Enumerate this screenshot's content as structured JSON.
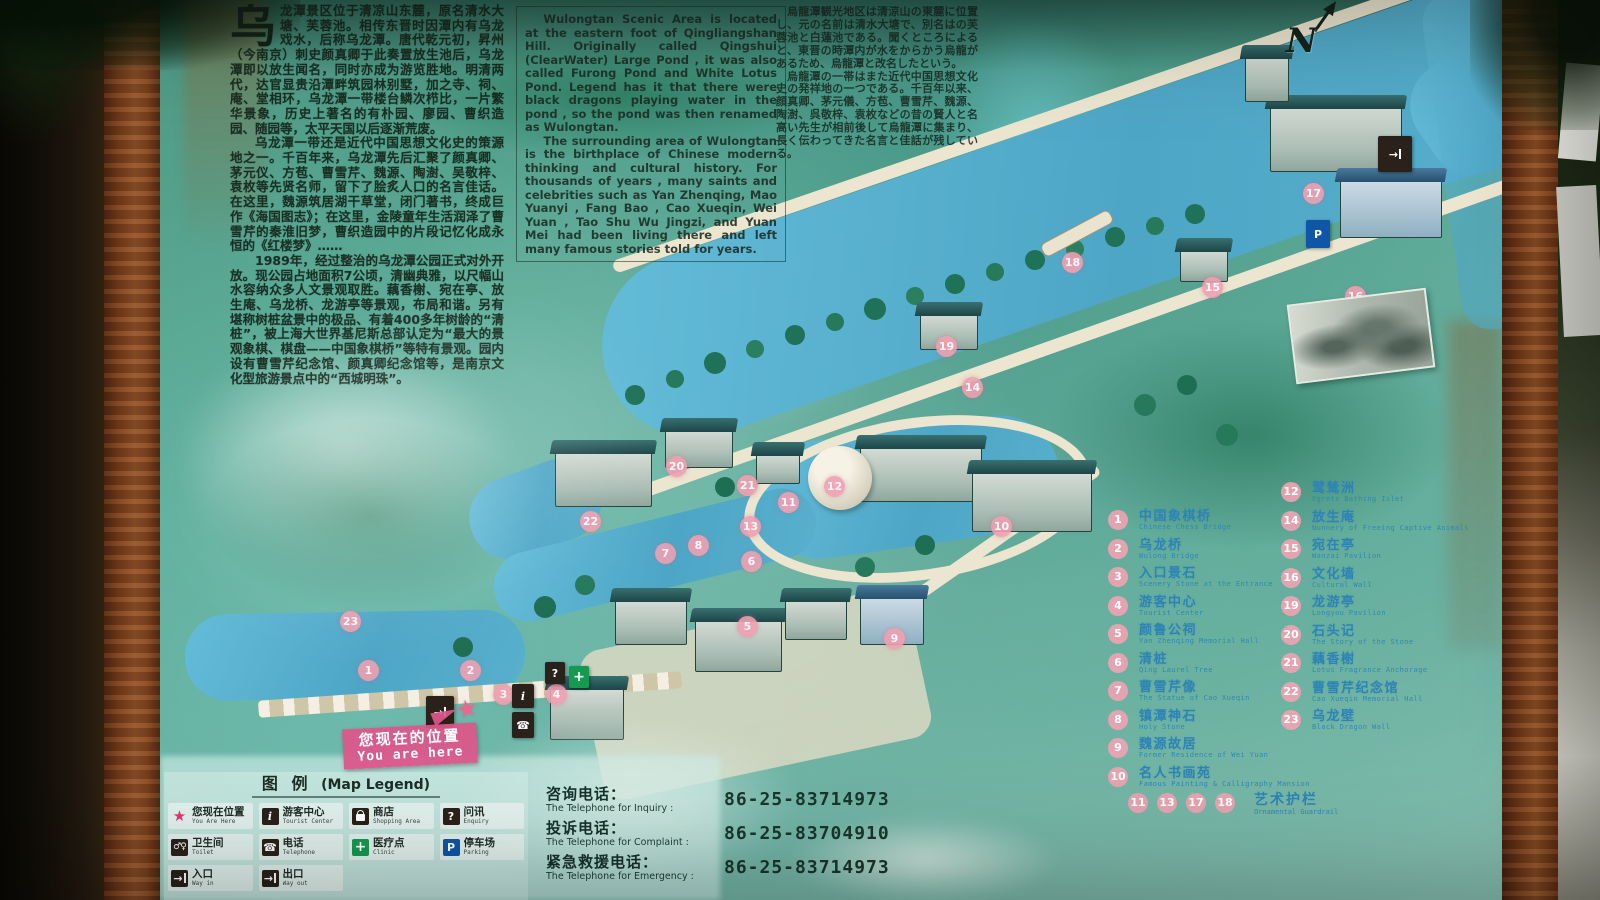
{
  "board": {
    "intro_zh": {
      "drop_cap": "乌",
      "p1": "龙潭景区位于清凉山东麓，原名清水大塘、芙蓉池。相传东晋时因潭内有乌龙戏水，后称乌龙潭。唐代乾元初，昇州（今南京）刺史颜真卿于此奏置放生池后，乌龙潭即以放生闻名，同时亦成为游览胜地。明清两代，达官显贵沿潭畔筑园林别墅，加之寺、祠、庵、堂相环，乌龙潭一带楼台鳞次栉比，一片繁华景象，历史上著名的有朴园、廖园、曹织造园、随园等，太平天国以后逐渐荒废。",
      "p2": "乌龙潭一带还是近代中国思想文化史的策源地之一。千百年来，乌龙潭先后汇聚了颜真卿、茅元仪、方苞、曹雪芹、魏源、陶澍、吴敬梓、袁枚等先贤名师，留下了脍炙人口的名言佳话。在这里，魏源筑居湖干草堂，闭门著书，终成巨作《海国图志》；在这里，金陵童年生活润泽了曹雪芹的秦淮旧梦，曹织造园中的片段记忆化成永恒的《红楼梦》……",
      "p3": "1989年，经过整治的乌龙潭公园正式对外开放。现公园占地面积7公顷，清幽典雅，以尺幅山水容纳众多人文景观取胜。藕香榭、宛在亭、放生庵、乌龙桥、龙游亭等景观，布局和谐。另有堪称树桩盆景中的极品、有着400多年树龄的“清桩”，被上海大世界基尼斯总部认定为“最大的景观象棋、棋盘——中国象棋桥”等特有景观。园内设有曹雪芹纪念馆、颜真卿纪念馆等，是南京文化型旅游景点中的“西城明珠”。"
    },
    "intro_en": {
      "p1": "Wulongtan Scenic Area is located at the eastern foot of Qingliangshan Hill. Originally called Qingshui (ClearWater) Large Pond , it was also called Furong Pond and White Lotus Pond. Legend has it that there were black dragons playing water in the pond , so the pond was then renamed as Wulongtan.",
      "p2": "The surrounding area of Wulongtan is the birthplace of Chinese modern thinking and cultural history. For thousands of years , many saints and celebrities such as Yan Zhenqing, Mao Yuanyi , Fang Bao , Cao Xueqin, Wei Yuan , Tao Shu Wu Jingzi, and Yuan Mei had been living there and left many famous stories told for years."
    },
    "intro_ja": {
      "p1": "烏龍潭観光地区は清涼山の東麓に位置し、元の名前は清水大塘で、別名はの芙蓉池と白蓮池である。聞くところによると、東晋の時潭内が水をからかう烏龍があるため、烏龍潭と改名したという。",
      "p2": "烏龍潭の一帯はまた近代中国思想文化史の発祥地の一つである。千百年以来、顔真卿、茅元儀、方苞、曹雪芹、魏源、陶澍、呉敬梓、袁枚などの昔の賢人と名高い先生が相前後して烏龍潭に集まり、長く伝わってきた名言と佳話が残している。"
    },
    "compass": {
      "label": "N"
    },
    "you_are_here": {
      "zh": "您现在的位置",
      "en": "You are here"
    },
    "map_markers": [
      {
        "n": "1",
        "x": "198px",
        "y": "660px"
      },
      {
        "n": "2",
        "x": "300px",
        "y": "660px"
      },
      {
        "n": "3",
        "x": "333px",
        "y": "684px"
      },
      {
        "n": "4",
        "x": "386px",
        "y": "684px"
      },
      {
        "n": "5",
        "x": "577px",
        "y": "616px"
      },
      {
        "n": "6",
        "x": "581px",
        "y": "551px"
      },
      {
        "n": "7",
        "x": "495px",
        "y": "543px"
      },
      {
        "n": "8",
        "x": "528px",
        "y": "535px"
      },
      {
        "n": "9",
        "x": "724px",
        "y": "628px"
      },
      {
        "n": "10",
        "x": "831px",
        "y": "516px"
      },
      {
        "n": "11",
        "x": "618px",
        "y": "492px"
      },
      {
        "n": "12",
        "x": "664px",
        "y": "476px"
      },
      {
        "n": "13",
        "x": "580px",
        "y": "516px"
      },
      {
        "n": "14",
        "x": "802px",
        "y": "377px"
      },
      {
        "n": "15",
        "x": "1042px",
        "y": "277px"
      },
      {
        "n": "16",
        "x": "1185px",
        "y": "286px"
      },
      {
        "n": "17",
        "x": "1143px",
        "y": "183px"
      },
      {
        "n": "18",
        "x": "902px",
        "y": "252px"
      },
      {
        "n": "19",
        "x": "776px",
        "y": "336px"
      },
      {
        "n": "20",
        "x": "506px",
        "y": "456px"
      },
      {
        "n": "21",
        "x": "577px",
        "y": "475px"
      },
      {
        "n": "22",
        "x": "420px",
        "y": "511px"
      },
      {
        "n": "23",
        "x": "180px",
        "y": "611px"
      }
    ],
    "poi_legend": {
      "col1": [
        {
          "n": "1",
          "zh": "中国象棋桥",
          "en": "Chinese Chess Bridge"
        },
        {
          "n": "2",
          "zh": "乌龙桥",
          "en": "Wulong Bridge"
        },
        {
          "n": "3",
          "zh": "入口景石",
          "en": "Scenery Stone at the Entrance"
        },
        {
          "n": "4",
          "zh": "游客中心",
          "en": "Tourist Center"
        },
        {
          "n": "5",
          "zh": "颜鲁公祠",
          "en": "Yan Zhenqing Memorial Hall"
        },
        {
          "n": "6",
          "zh": "清桩",
          "en": "Qing Laurel Tree"
        },
        {
          "n": "7",
          "zh": "曹雪芹像",
          "en": "The Statue of Cao Xueqin"
        },
        {
          "n": "8",
          "zh": "镇潭神石",
          "en": "Holy Stone"
        },
        {
          "n": "9",
          "zh": "魏源故居",
          "en": "Former Residence of Wei Yuan"
        },
        {
          "n": "10",
          "zh": "名人书画苑",
          "en": "Famous Painting & Calligraphy Mansion"
        }
      ],
      "col2": [
        {
          "n": "12",
          "zh": "鹭鸶洲",
          "en": "Egrets Bathing Islet"
        },
        {
          "n": "14",
          "zh": "放生庵",
          "en": "Nunnery of Freeing Captive Animals"
        },
        {
          "n": "15",
          "zh": "宛在亭",
          "en": "Wanzai Pavilion"
        },
        {
          "n": "16",
          "zh": "文化墙",
          "en": "Cultural Wall"
        },
        {
          "n": "19",
          "zh": "龙游亭",
          "en": "Longyou Pavilion"
        },
        {
          "n": "20",
          "zh": "石头记",
          "en": "The Story of the Stone"
        },
        {
          "n": "21",
          "zh": "藕香榭",
          "en": "Lotus Fragrance Anchorage"
        },
        {
          "n": "22",
          "zh": "曹雪芹纪念馆",
          "en": "Cao Xueqin Memorial Hall"
        },
        {
          "n": "23",
          "zh": "乌龙壁",
          "en": "Black Dragon Wall"
        }
      ],
      "group_nums": [
        "11",
        "13",
        "17",
        "18"
      ],
      "group": {
        "zh": "艺术护栏",
        "en": "Ornamental Guardrail"
      }
    },
    "map_legend": {
      "title_zh": "图 例",
      "title_en": "(Map Legend)",
      "items": [
        {
          "icon": "star",
          "zh": "您现在位置",
          "en": "You Are Here"
        },
        {
          "icon": "info",
          "zh": "游客中心",
          "en": "Tourist Center"
        },
        {
          "icon": "shop",
          "zh": "商店",
          "en": "Shopping Area"
        },
        {
          "icon": "enquiry",
          "zh": "问讯",
          "en": "Enquiry"
        },
        {
          "icon": "toilet",
          "zh": "卫生间",
          "en": "Toilet"
        },
        {
          "icon": "phone",
          "zh": "电话",
          "en": "Telephone"
        },
        {
          "icon": "clinic",
          "zh": "医疗点",
          "en": "Clinic"
        },
        {
          "icon": "parking",
          "zh": "停车场",
          "en": "Parking"
        },
        {
          "icon": "wayin",
          "zh": "入口",
          "en": "Way in"
        },
        {
          "icon": "wayout",
          "zh": "出口",
          "en": "Way out"
        }
      ]
    },
    "contacts": [
      {
        "zh": "咨询电话：",
        "en": "The Telephone for Inquiry :",
        "number": "86-25-83714973"
      },
      {
        "zh": "投诉电话：",
        "en": "The Telephone for Complaint :",
        "number": "86-25-83704910"
      },
      {
        "zh": "紧急救援电话：",
        "en": "The Telephone for Emergency :",
        "number": "86-25-83714973"
      }
    ]
  }
}
